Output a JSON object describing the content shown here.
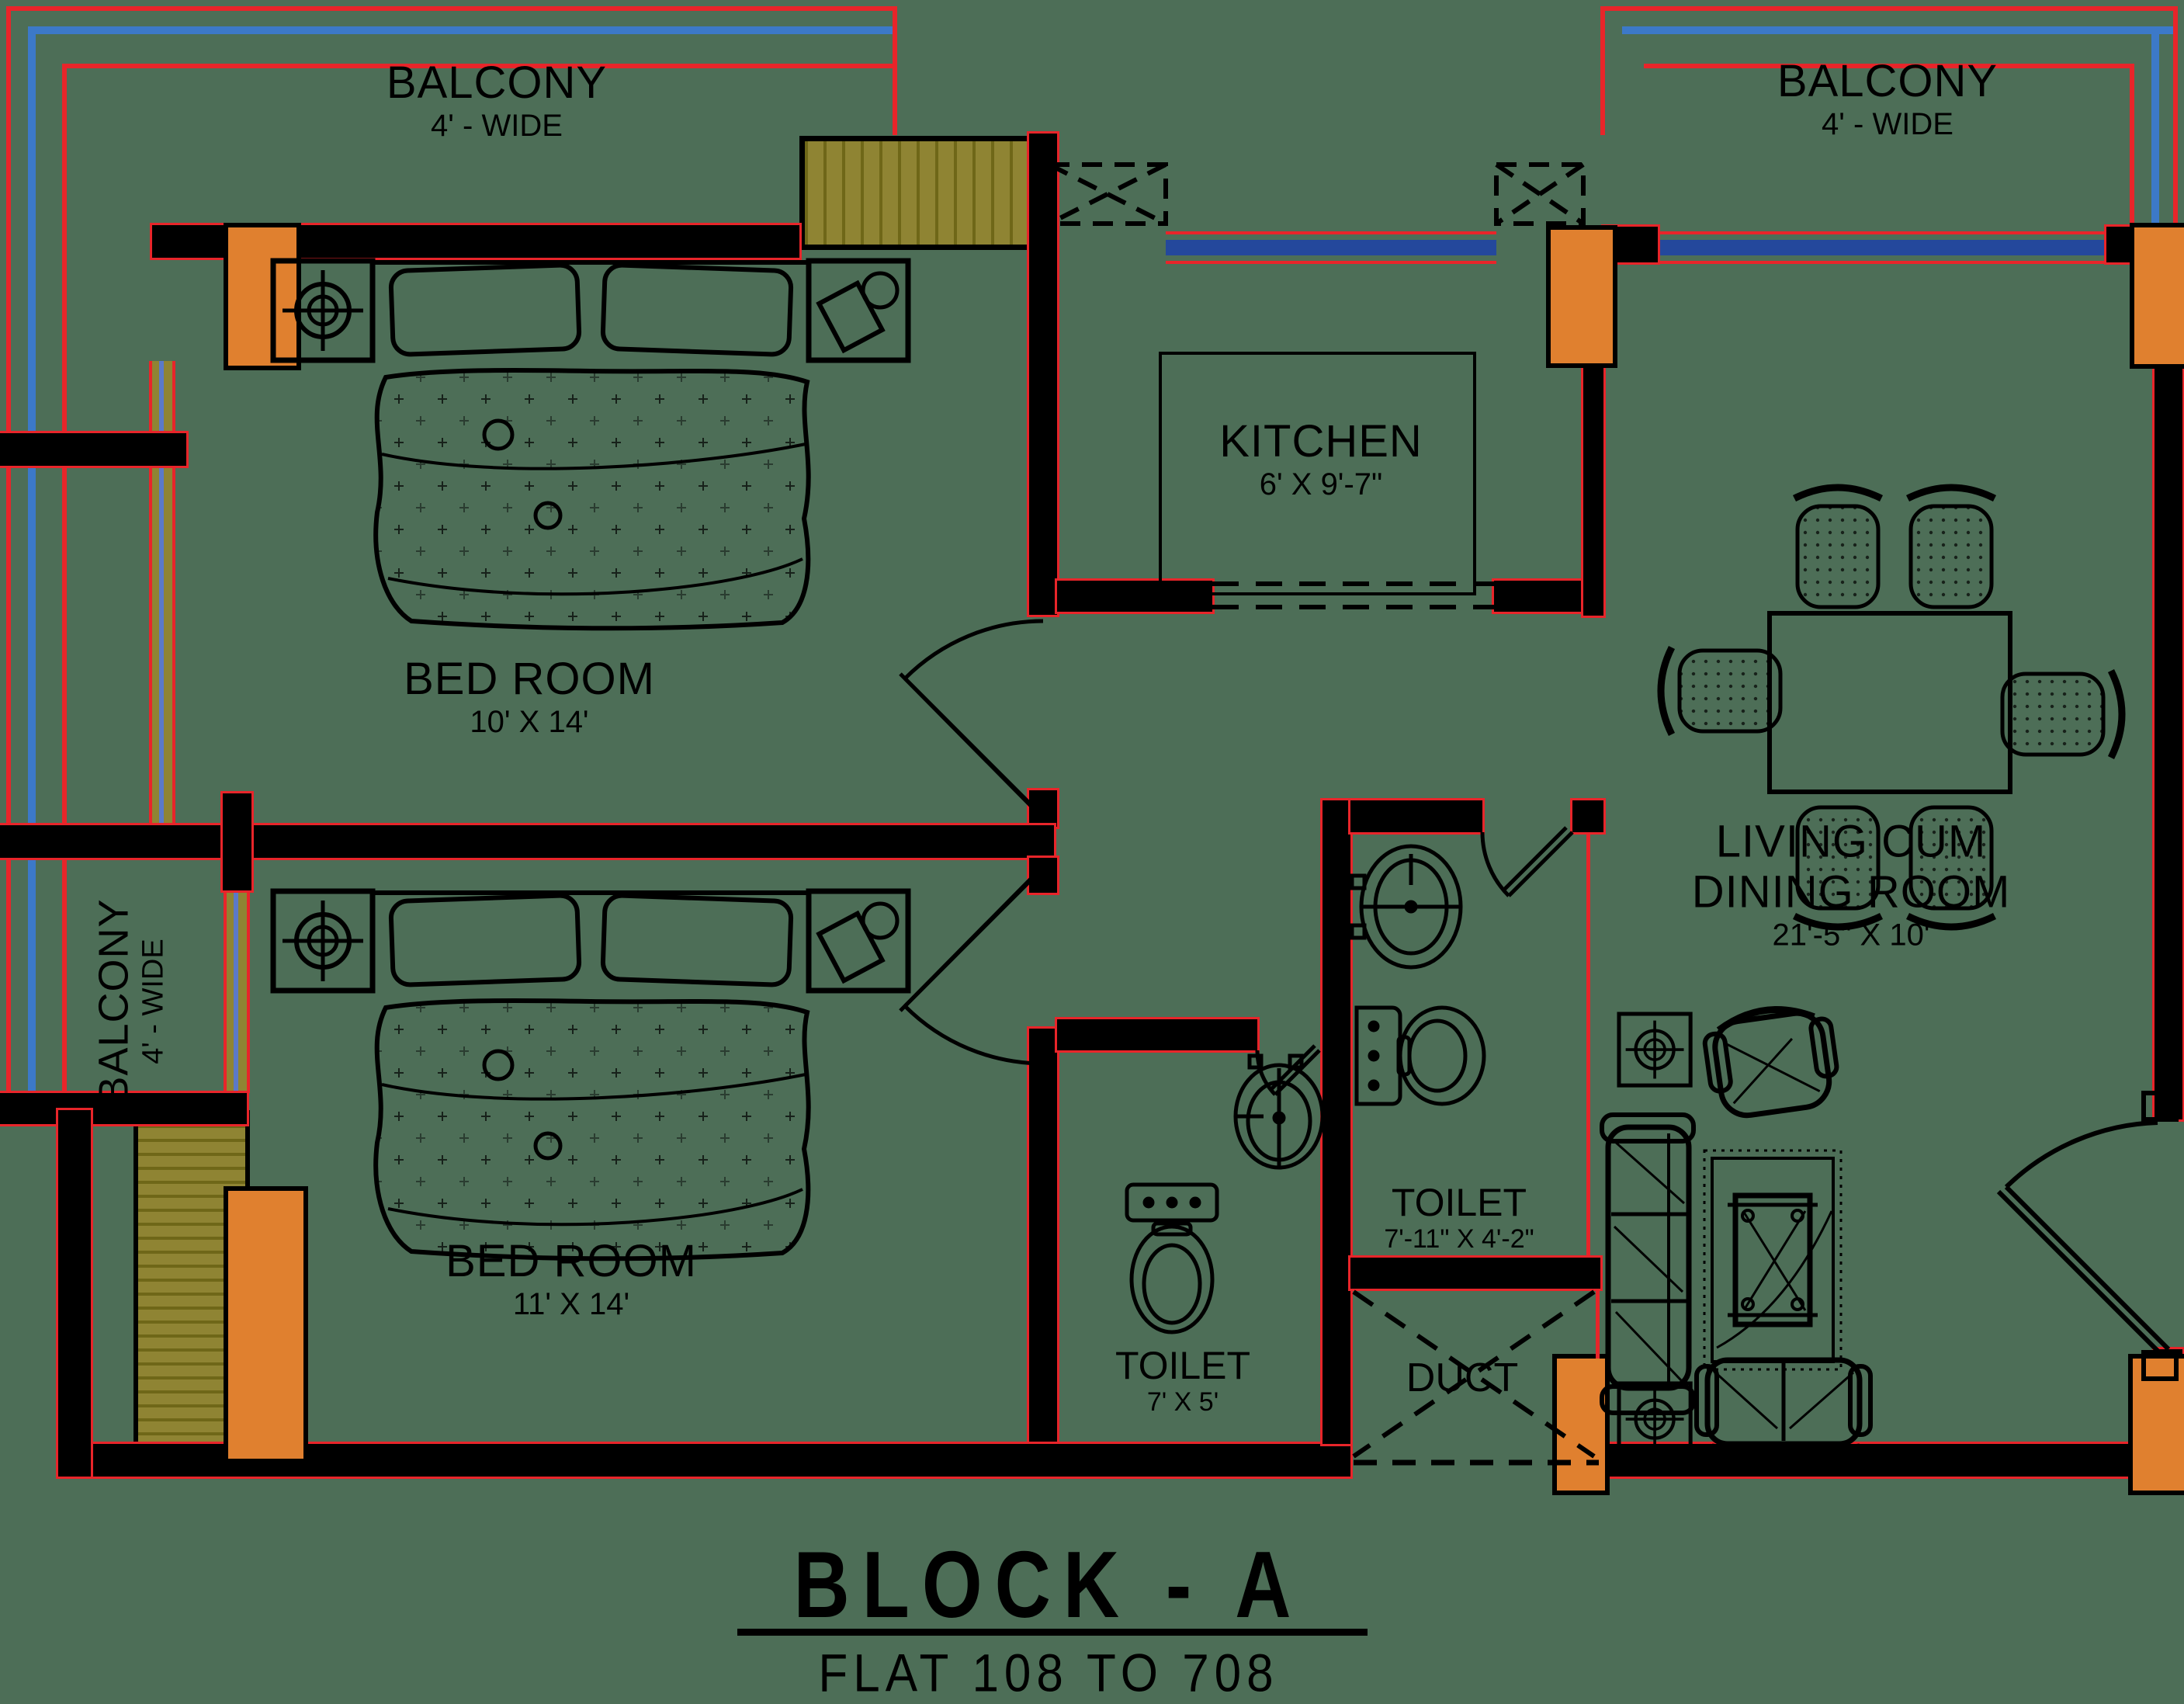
{
  "title": {
    "block": "BLOCK - A",
    "flats": "FLAT 108 TO 708"
  },
  "rooms": {
    "balcony_top_left": {
      "name": "BALCONY",
      "size": "4' - WIDE"
    },
    "balcony_top_right": {
      "name": "BALCONY",
      "size": "4' - WIDE"
    },
    "balcony_left": {
      "name": "BALCONY",
      "size": "4' - WIDE"
    },
    "bedroom1": {
      "name": "BED ROOM",
      "size": "10' X 14'"
    },
    "bedroom2": {
      "name": "BED ROOM",
      "size": "11' X 14'"
    },
    "kitchen": {
      "name": "KITCHEN",
      "size": "6' X 9'-7\""
    },
    "living": {
      "name_line1": "LIVING CUM",
      "name_line2": "DINING ROOM",
      "size": "21'-5\" X 10'"
    },
    "toilet1": {
      "name": "TOILET",
      "size": "7'-11\" X 4'-2\""
    },
    "toilet2": {
      "name": "TOILET",
      "size": "7' X 5'"
    },
    "duct": {
      "name": "DUCT"
    }
  },
  "colors": {
    "background": "#4d6e57",
    "wall": "#000000",
    "accent_red": "#e8252a",
    "rail_blue": "#3c79c8",
    "window_blue": "#24489c",
    "column_orange": "#e0802f",
    "hatch_olive": "#8f8433"
  }
}
